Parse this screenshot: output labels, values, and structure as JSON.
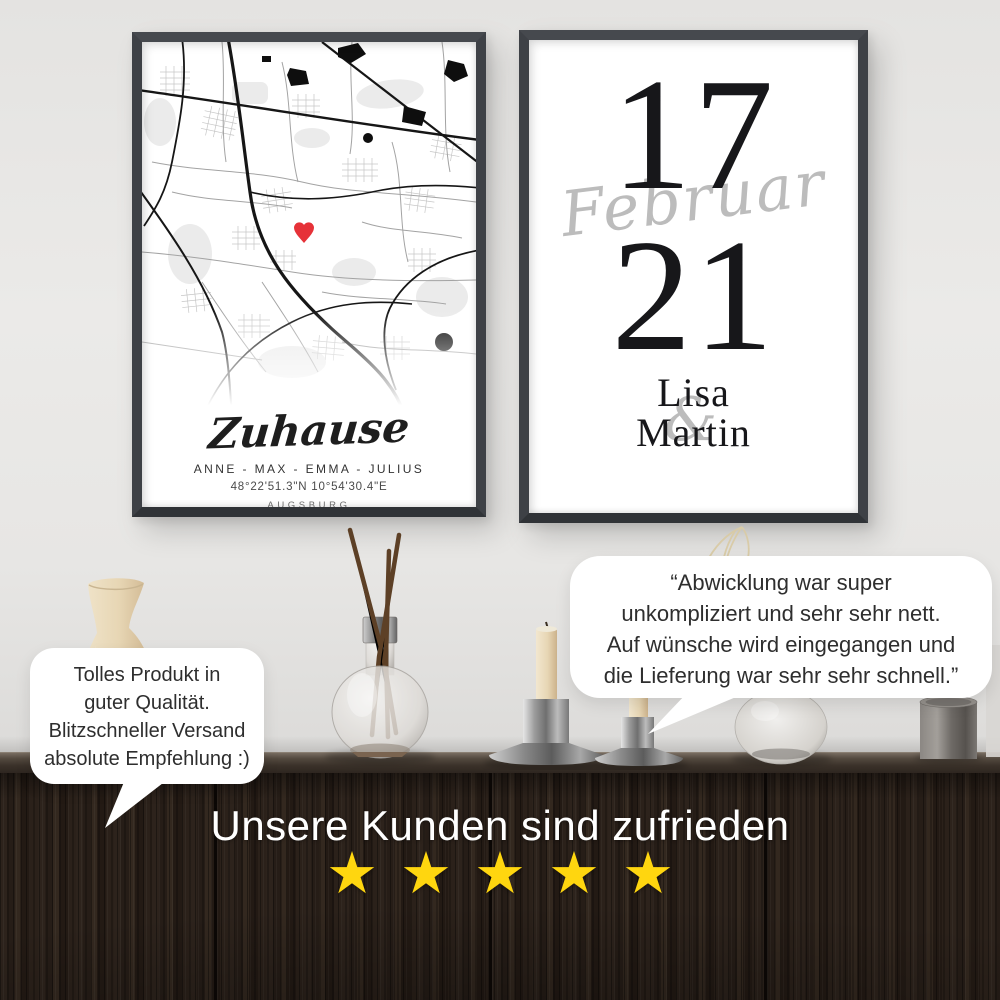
{
  "posters": {
    "map_poster": {
      "title_script": "Zuhause",
      "names": "ANNE - MAX - EMMA - JULIUS",
      "coordinates": "48°22'51.3\"N 10°54'30.4\"E",
      "city": "AUGSBURG",
      "heart_color": "#e63238"
    },
    "date_poster": {
      "day": "17",
      "month_script": "Februar",
      "year": "21",
      "name_top": "Lisa",
      "ampersand": "&",
      "name_bottom": "Martin",
      "script_color": "#bcbcbc"
    }
  },
  "testimonials": {
    "left_bubble": {
      "lines": [
        "Tolles Produkt in",
        "guter Qualität.",
        "Blitzschneller Versand",
        "absolute Empfehlung :)"
      ]
    },
    "right_bubble": {
      "lines": [
        "“Abwicklung war super",
        "unkompliziert und sehr sehr nett.",
        "Auf wünsche wird eingegangen und",
        "die Lieferung war sehr sehr schnell.”"
      ]
    }
  },
  "footer": {
    "headline": "Unsere Kunden sind zufrieden",
    "rating": 5,
    "star_icon": "★",
    "star_color": "#ffd60f"
  }
}
